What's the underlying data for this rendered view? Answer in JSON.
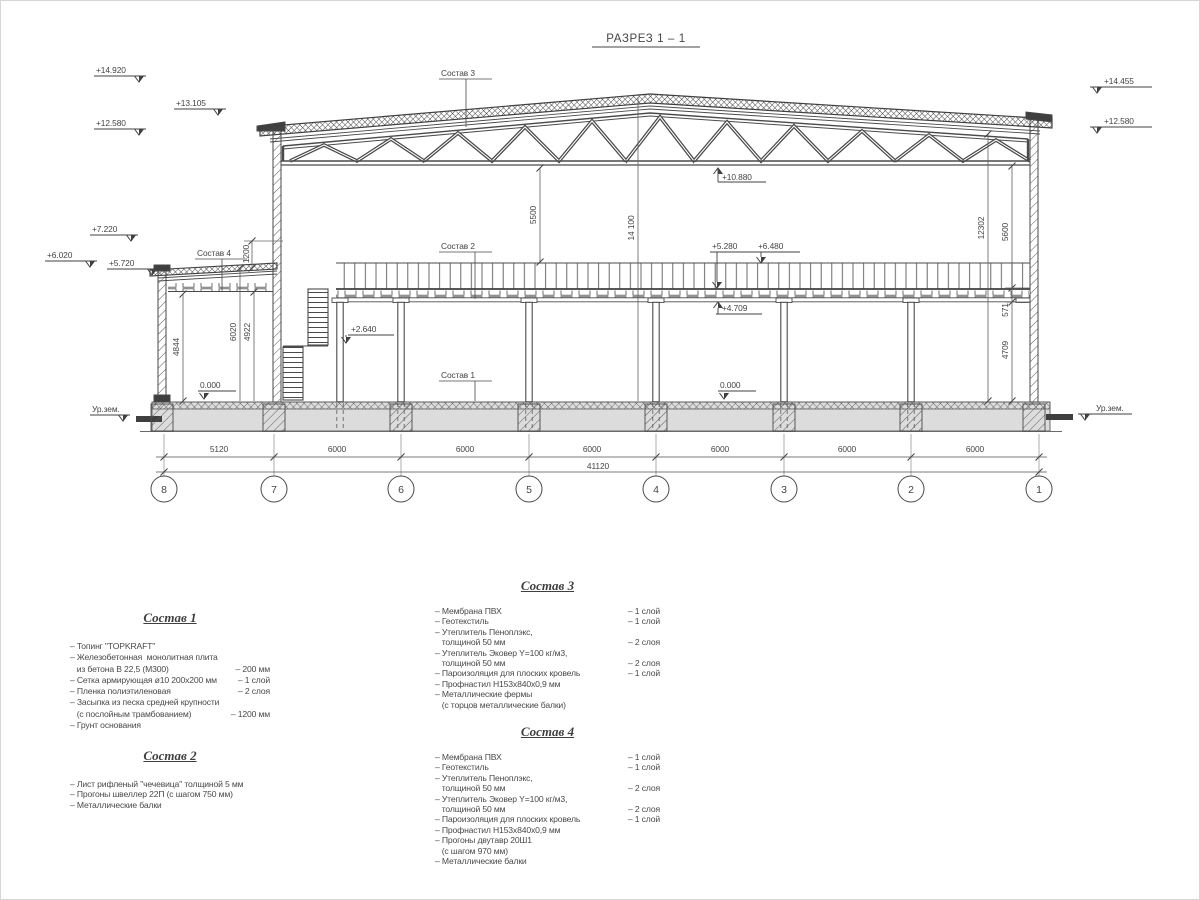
{
  "title": "РАЗРЕЗ 1 – 1",
  "levels": {
    "left": [
      "+14.920",
      "+13.105",
      "+12.580",
      "+7.220",
      "+6.020",
      "+5.720"
    ],
    "right": [
      "+14.455",
      "+12.580"
    ],
    "truss_bottom": "+10.880",
    "rail_top": "+6.480",
    "deck_top": "+5.280",
    "deck_bottom": "+4.709",
    "mid_level": "+2.640",
    "floor_annex": "0.000",
    "floor_main": "0.000",
    "ground_left": "Ур.зем.",
    "ground_right": "Ур.зем."
  },
  "dims": {
    "bottom": [
      "5120",
      "6000",
      "6000",
      "6000",
      "6000",
      "6000",
      "6000"
    ],
    "total": "41120",
    "truss_clear": "5500",
    "ridge_height": "14 100",
    "right_total": "12302",
    "right_upper": "5600",
    "deck_depth": "571",
    "under_deck": "4709",
    "annex_clear": "4844",
    "annex_total": "6020",
    "annex_inner": "4922",
    "parapet": "1200"
  },
  "grid_labels": [
    "8",
    "7",
    "6",
    "5",
    "4",
    "3",
    "2",
    "1"
  ],
  "callouts": {
    "sostav1": "Состав 1",
    "sostav2": "Состав 2",
    "sostav3": "Состав 3",
    "sostav4": "Состав 4"
  },
  "legend": {
    "sostav1": {
      "title": "Состав 1",
      "items": [
        {
          "text": "– Топинг \"TOPKRAFT\"",
          "qty": ""
        },
        {
          "text": "– Железобетонная  монолитная плита",
          "qty": ""
        },
        {
          "text": "   из бетона В 22,5 (М300)",
          "qty": "– 200 мм"
        },
        {
          "text": "– Сетка армирующая ø10 200х200 мм",
          "qty": "– 1 слой"
        },
        {
          "text": "– Пленка полиэтиленовая",
          "qty": "– 2 слоя"
        },
        {
          "text": "– Засыпка из песка средней крупности",
          "qty": ""
        },
        {
          "text": "   (с послойным трамбованием)",
          "qty": "– 1200 мм"
        },
        {
          "text": "– Грунт основания",
          "qty": ""
        }
      ]
    },
    "sostav2": {
      "title": "Состав 2",
      "items": [
        {
          "text": "– Лист рифленый \"чечевица\" толщиной 5 мм",
          "qty": ""
        },
        {
          "text": "– Прогоны швеллер 22П (с шагом 750 мм)",
          "qty": ""
        },
        {
          "text": "– Металлические балки",
          "qty": ""
        }
      ]
    },
    "sostav3": {
      "title": "Состав 3",
      "items": [
        {
          "text": "– Мембрана ПВХ",
          "qty": "– 1 слой"
        },
        {
          "text": "– Геотекстиль",
          "qty": "– 1 слой"
        },
        {
          "text": "– Утеплитель Пеноплэкс,",
          "qty": ""
        },
        {
          "text": "   толщиной 50 мм",
          "qty": "– 2 слоя"
        },
        {
          "text": "– Утеплитель Эковер Y=100 кг/м3,",
          "qty": ""
        },
        {
          "text": "   толщиной 50 мм",
          "qty": "– 2 слоя"
        },
        {
          "text": "– Пароизоляция для плоских кровель",
          "qty": "– 1 слой"
        },
        {
          "text": "– Профнастил Н153х840х0,9 мм",
          "qty": ""
        },
        {
          "text": "– Металлические фермы",
          "qty": ""
        },
        {
          "text": "   (с торцов металлические балки)",
          "qty": ""
        }
      ]
    },
    "sostav4": {
      "title": "Состав 4",
      "items": [
        {
          "text": "– Мембрана ПВХ",
          "qty": "– 1 слой"
        },
        {
          "text": "– Геотекстиль",
          "qty": "– 1 слой"
        },
        {
          "text": "– Утеплитель Пеноплэкс,",
          "qty": ""
        },
        {
          "text": "   толщиной 50 мм",
          "qty": "– 2 слоя"
        },
        {
          "text": "– Утеплитель Эковер Y=100 кг/м3,",
          "qty": ""
        },
        {
          "text": "   толщиной 50 мм",
          "qty": "– 2 слоя"
        },
        {
          "text": "– Пароизоляция для плоских кровель",
          "qty": "– 1 слой"
        },
        {
          "text": "– Профнастил Н153х840х0,9 мм",
          "qty": ""
        },
        {
          "text": "– Прогоны двутавр 20Ш1",
          "qty": ""
        },
        {
          "text": "   (с шагом 970 мм)",
          "qty": ""
        },
        {
          "text": "– Металлические балки",
          "qty": ""
        }
      ]
    }
  }
}
